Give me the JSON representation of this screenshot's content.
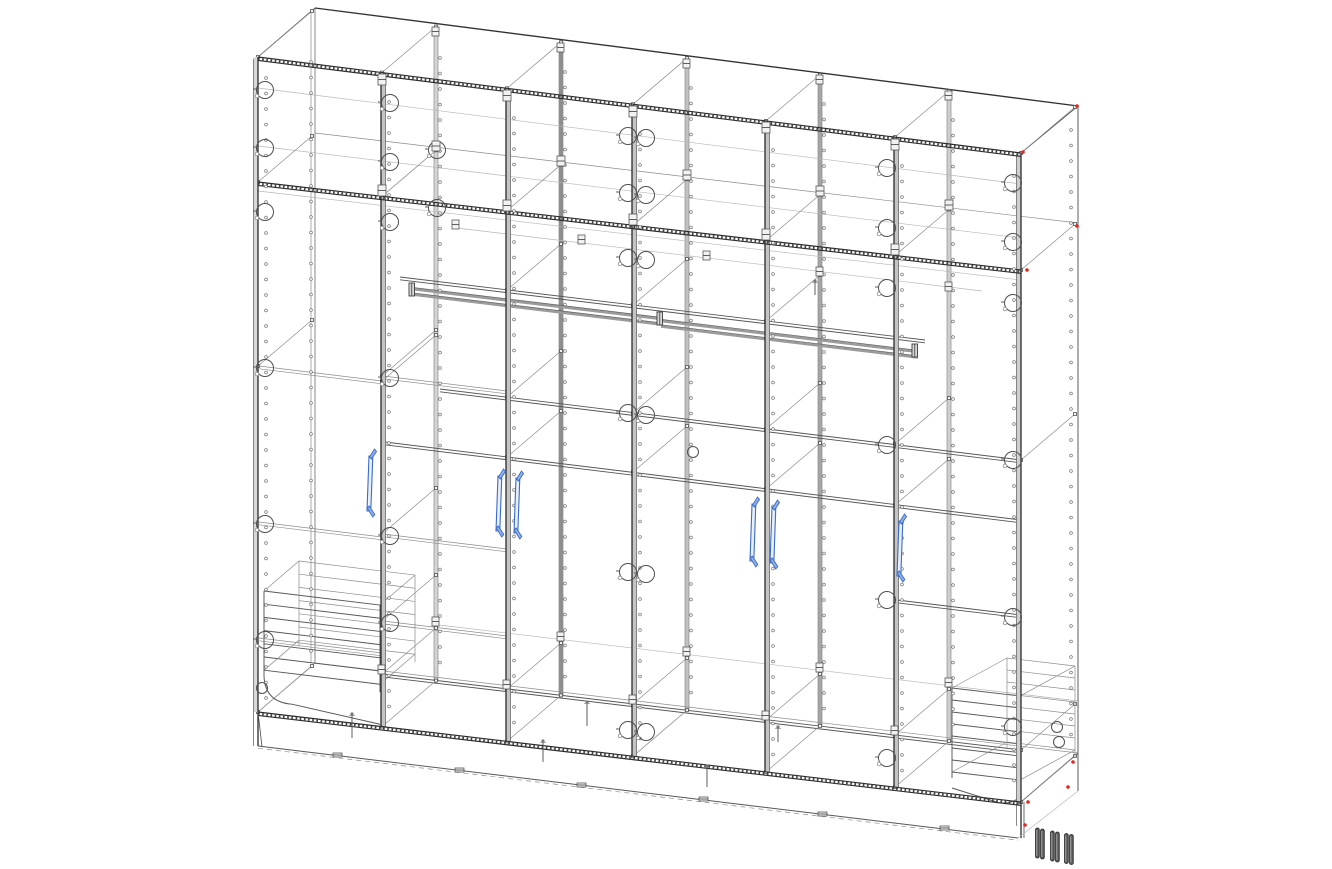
{
  "app": {
    "name": "cad-wireframe-viewport",
    "background": "#ffffff"
  },
  "drawing": {
    "colors": {
      "line": "#4a4a4a",
      "line_light": "#8c8c8c",
      "line_faint": "#b6b6b6",
      "heavy": "#2c2c2c",
      "panel_band": "#c4c4c4",
      "side_band": "#d8d8d8",
      "handle_stroke": "#3a6bc6",
      "handle_fill": "#e9f0fb",
      "handle_accent": "#8fb0e8",
      "foot_fill": "#585858",
      "foot_stroke": "#2b2b2b",
      "foot_highlight": "#a8a8a8",
      "red_marker": "#e2261f",
      "tube": "#9b9b9b"
    },
    "frame": {
      "front_top": [
        [
          258,
          57
        ],
        [
          1021,
          153
        ]
      ],
      "back_top": [
        [
          315,
          8
        ],
        [
          1078,
          106
        ]
      ],
      "mezzanine": [
        [
          258,
          182
        ],
        [
          1021,
          270
        ]
      ],
      "bottom": [
        [
          258,
          712
        ],
        [
          1021,
          802
        ]
      ],
      "plinth": [
        [
          258,
          746
        ],
        [
          1018,
          838
        ]
      ],
      "back_bottom": [
        [
          315,
          663
        ],
        [
          1078,
          753
        ]
      ],
      "depth": [
        54,
        -46
      ],
      "left_x": 258,
      "right_x": 1021,
      "back_left_x": 315,
      "back_right_x": 1078
    },
    "partitions": [
      {
        "front": 382,
        "rear": 436,
        "rear_fill": "#d4d4d4"
      },
      {
        "front": 507,
        "rear": 561,
        "rear_fill": "#8e8e8e"
      },
      {
        "front": 633,
        "rear": 687,
        "rear_fill": "#c2c2c2"
      },
      {
        "front": 766,
        "rear": 820,
        "rear_fill": "#a6a6a6"
      },
      {
        "front": 895,
        "rear": 949,
        "rear_fill": "#cfcfcf"
      }
    ],
    "shelf_lines": [
      {
        "p1": [
          258,
          88
        ],
        "p2": [
          1021,
          184
        ],
        "style": "ft"
      },
      {
        "p1": [
          258,
          146
        ],
        "p2": [
          1021,
          238
        ],
        "style": "ft"
      },
      {
        "p1": [
          315,
          133
        ],
        "p2": [
          1078,
          223
        ],
        "style": "lt"
      },
      {
        "p1": [
          258,
          191
        ],
        "p2": [
          1021,
          280
        ],
        "style": "ft"
      },
      {
        "p1": [
          400,
          277
        ],
        "p2": [
          925,
          340
        ],
        "style": "md",
        "dbl": true
      },
      {
        "p1": [
          457,
          228
        ],
        "p2": [
          982,
          291
        ],
        "style": "ft"
      },
      {
        "p1": [
          440,
          389
        ],
        "p2": [
          1021,
          460
        ],
        "style": "md",
        "dbl": true
      },
      {
        "p1": [
          385,
          442
        ],
        "p2": [
          1021,
          520
        ],
        "style": "md",
        "dbl": true
      },
      {
        "p1": [
          897,
          600
        ],
        "p2": [
          1021,
          615
        ],
        "style": "md",
        "dbl": true
      },
      {
        "p1": [
          315,
          663
        ],
        "p2": [
          1078,
          753
        ],
        "style": "lt"
      },
      {
        "p1": [
          382,
          674
        ],
        "p2": [
          1021,
          750
        ],
        "style": "md",
        "dbl": true
      },
      {
        "p1": [
          439,
          625
        ],
        "p2": [
          1078,
          701
        ],
        "style": "ft"
      },
      {
        "p1": [
          259,
          366
        ],
        "p2": [
          382,
          381
        ],
        "style": "lt",
        "dbl": true
      },
      {
        "p1": [
          259,
          522
        ],
        "p2": [
          382,
          537
        ],
        "style": "lt",
        "dbl": true
      },
      {
        "p1": [
          259,
          638
        ],
        "p2": [
          382,
          653
        ],
        "style": "lt",
        "dbl": true
      },
      {
        "p1": [
          383,
          376
        ],
        "p2": [
          507,
          391
        ],
        "style": "lt",
        "dbl": true
      },
      {
        "p1": [
          383,
          534
        ],
        "p2": [
          507,
          549
        ],
        "style": "lt",
        "dbl": true
      },
      {
        "p1": [
          383,
          621
        ],
        "p2": [
          507,
          636
        ],
        "style": "lt",
        "dbl": true
      }
    ],
    "depth_diagonals": [
      [
        258,
        57
      ],
      [
        382,
        72.6
      ],
      [
        507,
        88.3
      ],
      [
        633,
        104.2
      ],
      [
        766,
        120.9
      ],
      [
        895,
        137.1
      ],
      [
        1021,
        153
      ],
      [
        258,
        182
      ],
      [
        382,
        196.3
      ],
      [
        507,
        210.7
      ],
      [
        633,
        225.2
      ],
      [
        766,
        240.6
      ],
      [
        895,
        255.5
      ],
      [
        1021,
        270
      ],
      [
        507,
        290
      ],
      [
        633,
        305
      ],
      [
        766,
        321
      ],
      [
        507,
        397
      ],
      [
        633,
        413
      ],
      [
        766,
        429
      ],
      [
        895,
        444
      ],
      [
        1021,
        460
      ],
      [
        507,
        457
      ],
      [
        633,
        472
      ],
      [
        766,
        489
      ],
      [
        895,
        505
      ],
      [
        382,
        674
      ],
      [
        507,
        689
      ],
      [
        633,
        704
      ],
      [
        766,
        720
      ],
      [
        895,
        735
      ],
      [
        1021,
        750
      ],
      [
        258,
        712
      ],
      [
        382,
        726.6
      ],
      [
        507,
        741.4
      ],
      [
        633,
        756.2
      ],
      [
        766,
        771.9
      ],
      [
        895,
        787.1
      ],
      [
        1021,
        802
      ],
      [
        258,
        366
      ],
      [
        382,
        381
      ],
      [
        382,
        376
      ],
      [
        382,
        534
      ],
      [
        382,
        621
      ]
    ],
    "hole_columns": [
      {
        "x": 266,
        "y0": 78,
        "y1": 700
      },
      {
        "x": 311,
        "y0": 62,
        "y1": 655
      },
      {
        "x": 389,
        "y0": 102,
        "y1": 718
      },
      {
        "x": 440,
        "y0": 58,
        "y1": 672
      },
      {
        "x": 514,
        "y0": 118,
        "y1": 733
      },
      {
        "x": 565,
        "y0": 72,
        "y1": 688
      },
      {
        "x": 640,
        "y0": 134,
        "y1": 748
      },
      {
        "x": 691,
        "y0": 88,
        "y1": 702
      },
      {
        "x": 773,
        "y0": 150,
        "y1": 764
      },
      {
        "x": 824,
        "y0": 104,
        "y1": 718
      },
      {
        "x": 902,
        "y0": 166,
        "y1": 779
      },
      {
        "x": 953,
        "y0": 120,
        "y1": 733
      },
      {
        "x": 1014,
        "y0": 176,
        "y1": 794
      },
      {
        "x": 1071,
        "y0": 130,
        "y1": 748
      }
    ],
    "hole_step": 15.5,
    "cam_circles": [
      [
        265,
        90
      ],
      [
        265,
        148
      ],
      [
        265,
        212
      ],
      [
        265,
        368
      ],
      [
        265,
        524
      ],
      [
        265,
        640
      ],
      [
        390,
        103
      ],
      [
        390,
        162
      ],
      [
        390,
        222
      ],
      [
        390,
        378
      ],
      [
        390,
        536
      ],
      [
        390,
        623
      ],
      [
        437,
        150
      ],
      [
        437,
        208
      ],
      [
        628,
        136
      ],
      [
        646,
        138
      ],
      [
        628,
        193
      ],
      [
        646,
        195
      ],
      [
        628,
        258
      ],
      [
        646,
        260
      ],
      [
        628,
        413
      ],
      [
        646,
        415
      ],
      [
        628,
        572
      ],
      [
        646,
        574
      ],
      [
        628,
        730
      ],
      [
        646,
        732
      ],
      [
        887,
        168
      ],
      [
        887,
        228
      ],
      [
        887,
        288
      ],
      [
        887,
        445
      ],
      [
        887,
        600
      ],
      [
        887,
        758
      ],
      [
        1013,
        183
      ],
      [
        1013,
        242
      ],
      [
        1013,
        303
      ],
      [
        1013,
        460
      ],
      [
        1013,
        617
      ],
      [
        1013,
        727
      ]
    ],
    "cam_small": [
      [
        262,
        688
      ],
      [
        693,
        452
      ],
      [
        1057,
        727
      ],
      [
        1059,
        742
      ]
    ],
    "fittings": [
      [
        378,
        74,
        8,
        11
      ],
      [
        503,
        90,
        8,
        11
      ],
      [
        629,
        106,
        8,
        11
      ],
      [
        762,
        122,
        8,
        11
      ],
      [
        891,
        139,
        8,
        11
      ],
      [
        432,
        27,
        7,
        9
      ],
      [
        557,
        43,
        7,
        9
      ],
      [
        683,
        59,
        7,
        9
      ],
      [
        816,
        75,
        7,
        9
      ],
      [
        945,
        91,
        7,
        9
      ],
      [
        378,
        185,
        8,
        11
      ],
      [
        503,
        200,
        8,
        11
      ],
      [
        629,
        214,
        8,
        11
      ],
      [
        762,
        229,
        8,
        11
      ],
      [
        891,
        244,
        8,
        11
      ],
      [
        432,
        141,
        8,
        10
      ],
      [
        557,
        156,
        8,
        10
      ],
      [
        683,
        170,
        8,
        10
      ],
      [
        816,
        186,
        8,
        10
      ],
      [
        945,
        200,
        8,
        10
      ],
      [
        452,
        220,
        7,
        9
      ],
      [
        578,
        235,
        7,
        9
      ],
      [
        703,
        251,
        7,
        9
      ],
      [
        816,
        267,
        7,
        9
      ],
      [
        945,
        282,
        7,
        9
      ],
      [
        432,
        617,
        7,
        9
      ],
      [
        557,
        632,
        7,
        9
      ],
      [
        683,
        647,
        7,
        9
      ],
      [
        816,
        663,
        7,
        9
      ],
      [
        945,
        678,
        7,
        9
      ],
      [
        378,
        665,
        7,
        9
      ],
      [
        503,
        680,
        7,
        9
      ],
      [
        629,
        695,
        7,
        9
      ],
      [
        762,
        711,
        7,
        9
      ],
      [
        891,
        726,
        7,
        9
      ],
      [
        333,
        753,
        9,
        4
      ],
      [
        455,
        768,
        9,
        4
      ],
      [
        577,
        783,
        9,
        4
      ],
      [
        699,
        797,
        9,
        4
      ],
      [
        818,
        812,
        9,
        4
      ],
      [
        940,
        826,
        9,
        4
      ]
    ],
    "rail": {
      "tube_gap": 5.5,
      "segments": [
        [
          [
            412,
            289
          ],
          [
            661,
            319
          ]
        ],
        [
          [
            661,
            321
          ],
          [
            918,
            352
          ]
        ]
      ],
      "brackets": [
        [
          409,
          283
        ],
        [
          657,
          312
        ],
        [
          912,
          344
        ]
      ]
    },
    "baskets": [
      {
        "x1": 264,
        "x2": 380,
        "y": 591,
        "rails": 7,
        "gap": 13.2,
        "slope": 0.121,
        "dx": 35,
        "dy": -30,
        "curve": "left"
      },
      {
        "x1": 952,
        "x2": 1020,
        "y": 688,
        "rails": 8,
        "gap": 12,
        "slope": 0.118,
        "dx": 55,
        "dy": -30,
        "curve": "right"
      }
    ],
    "pins": [
      [
        352,
        714,
        24
      ],
      [
        543,
        741,
        21
      ],
      [
        587,
        702,
        24
      ],
      [
        707,
        766,
        21
      ],
      [
        778,
        727,
        15
      ],
      [
        815,
        281,
        14
      ]
    ],
    "handles": [
      {
        "x": 369,
        "y": 449,
        "h": 69
      },
      {
        "x": 498,
        "y": 469,
        "h": 69
      },
      {
        "x": 516,
        "y": 471,
        "h": 69
      },
      {
        "x": 752,
        "y": 497,
        "h": 71
      },
      {
        "x": 772,
        "y": 500,
        "h": 70
      },
      {
        "x": 899,
        "y": 514,
        "h": 69
      }
    ],
    "feet": {
      "w": 3.8,
      "h": 30,
      "pos": [
        [
          1035.5,
          828
        ],
        [
          1040.5,
          829
        ],
        [
          1050.5,
          831
        ],
        [
          1055.5,
          832
        ],
        [
          1064.5,
          833.5
        ],
        [
          1069.5,
          834.5
        ]
      ]
    },
    "red_dots": [
      [
        1023,
        152
      ],
      [
        1077,
        106
      ],
      [
        1027,
        270
      ],
      [
        1077,
        226
      ],
      [
        1073,
        762
      ],
      [
        1068,
        787
      ],
      [
        1028,
        802
      ],
      [
        1025,
        825
      ]
    ]
  }
}
